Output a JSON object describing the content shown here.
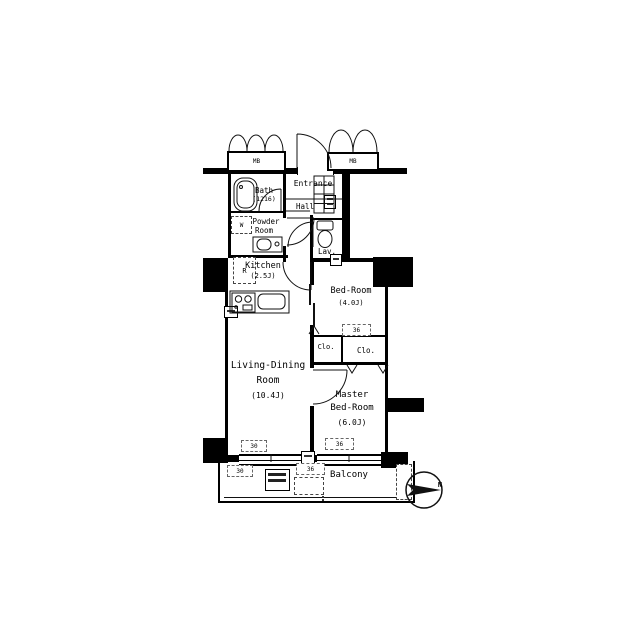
{
  "floorplan": {
    "meter_boxes": {
      "left": "MB",
      "right": "MB"
    },
    "rooms": {
      "bath": {
        "name": "Bath",
        "area": "(1216)"
      },
      "entrance": {
        "name": "Entrance"
      },
      "hall": {
        "name": "Hall"
      },
      "powder_room": {
        "name_line1": "Powder",
        "name_line2": "Room"
      },
      "lavatory": {
        "name": "Lav."
      },
      "kitchen": {
        "name": "Kitchen",
        "area": "(2.5J)"
      },
      "bedroom": {
        "name": "Bed-Room",
        "area": "(4.0J)"
      },
      "closet_left": {
        "name": "Clo."
      },
      "closet_right": {
        "name": "Clo."
      },
      "living_dining": {
        "name_line1": "Living-Dining",
        "name_line2": "Room",
        "area": "(10.4J)"
      },
      "master_bedroom": {
        "name_line1": "Master",
        "name_line2": "Bed-Room",
        "area": "(6.0J)"
      },
      "balcony": {
        "name": "Balcony"
      }
    },
    "appliances": {
      "washer": "W",
      "refrigerator": "R"
    },
    "window_marks": {
      "closet_top": "36",
      "living_bottom": "30",
      "master_bottom": "36",
      "balcony_left": "30",
      "balcony_center": "36"
    },
    "compass": {
      "north": "N"
    }
  },
  "colors": {
    "wall": "#000000",
    "ink": "#111111",
    "background": "#ffffff"
  }
}
